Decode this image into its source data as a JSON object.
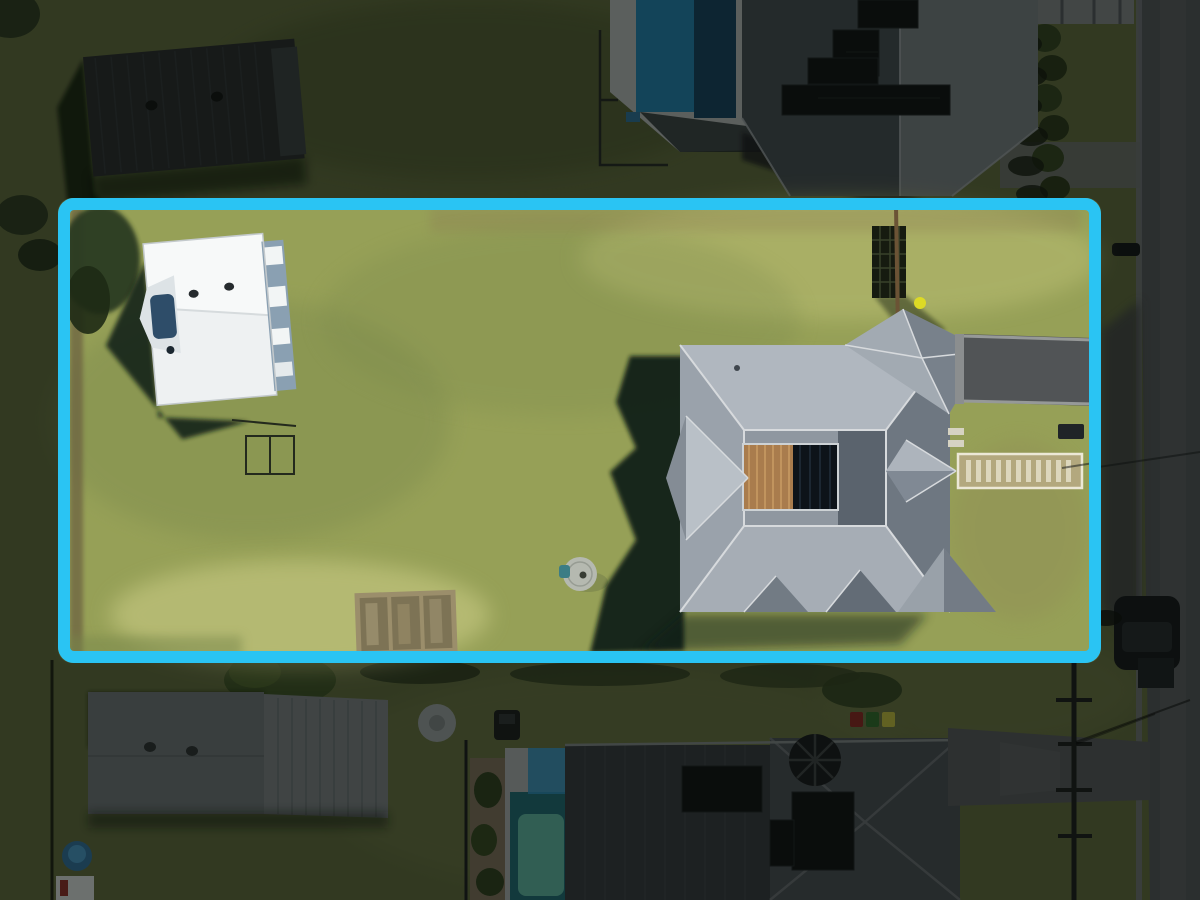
{
  "scene": {
    "type": "aerial-drone-photo",
    "description": "Top-down aerial photograph of a residential allotment outlined with a thick cyan boundary; large lawn with white shed on the left, grey hip-roof house with central courtyard deck on the right, driveway and paver path to the street; neighbouring houses, pools and road are dimmed outside the boundary",
    "highlight": {
      "shape": "rounded-rectangle",
      "border_color": "#2ac4f3"
    },
    "objects": [
      "boundary-highlight",
      "lot-lawn",
      "white-shed",
      "boat",
      "clothesline",
      "garden-beds",
      "concrete-pad",
      "trellis-gate",
      "yellow-ball",
      "main-house",
      "courtyard-deck",
      "driveway",
      "paver-path",
      "letterbox",
      "house-shadow",
      "shed-shadow",
      "neighbor-shed-top-left",
      "neighbor-house-top",
      "neighbor-pool-top",
      "hedge-row",
      "neighbor-shed-bottom-left",
      "kiddie-pool",
      "trailer",
      "round-pad",
      "mower",
      "neighbor-pool-bottom",
      "neighbor-house-bottom",
      "solar-panels",
      "wheelie-bins",
      "trampoline",
      "street-road",
      "power-pole",
      "parked-car"
    ]
  },
  "colors": {
    "cyan": "#2ac4f3",
    "dim": "rgba(9,13,10,0.52)",
    "grass_out": "#5f6a3c",
    "grass_out_light": "#6f7a46",
    "grass_out_dark": "#46512c",
    "grass_in": "#96a057",
    "grass_in_light": "#b9bd72",
    "grass_in_bright": "#c9cb84",
    "grass_in_dark": "#78874b",
    "dirt": "#8d7c52",
    "shadow": "#0d1a12",
    "tree_dark": "#2c3a20",
    "hedge": "#31411f",
    "road": "#515458",
    "road_light": "#5f6266",
    "road_dark": "#3f4245",
    "kerb": "#70737a",
    "wall_light": "#7f8486",
    "shed_dark": "#26292b",
    "shed_dark_end": "#383d3f",
    "shed_white": "#eef1f2",
    "shed_white_lit": "#f7f9f9",
    "shed_wall": "#8aa0b2",
    "boat_cover": "#2e4d69",
    "roof_n": "#767d83",
    "roof_n_shade": "#424a50",
    "solar": "#0b0e10",
    "pool_deck": "#b4b8b9",
    "pool_water": "#1f7fb0",
    "pool_water_dark": "#123f5e",
    "deck2": "#a9adaf",
    "pool2": "#1d6a74",
    "pool2_light": "#5cb7a4",
    "garden_rock": "#7d6f5b",
    "roof_b1": "#33383d",
    "roof_b2": "#454b52",
    "roof_b_ridge": "#6a7076",
    "drive2": "#54575a",
    "bin_red": "#8a2420",
    "bin_green": "#2f6b2a",
    "bin_yellow": "#c0bd3e",
    "tramp": "#141619",
    "pole": "#17191a",
    "car_body": "#111417",
    "car_top": "#23272b",
    "roof_lit": "#b0b7bf",
    "roof_mid": "#9aa2ab",
    "roof_low": "#a6adb5",
    "roof_dark": "#6e7781",
    "roof_inner": "#8f97a0",
    "roof_inner_dark": "#5a636d",
    "ridge": "#d7dadd",
    "courtyard_dark": "#0d1319",
    "deck_wood": "#a97c4d",
    "deck_wood_light": "#c79a63",
    "bay": "#adb4bc",
    "steps": "#d6d3c2",
    "drive": "#515456",
    "drive_edge": "#969998",
    "path_base": "#b3a87e",
    "path_border": "#ece8d6",
    "paver": "#ddd7bd",
    "letterbox": "#202427",
    "bed_wood": "#9b8e6b",
    "bed_soil": "#7d7355",
    "pad": "#b5b9b0",
    "pad_dot": "#383d34",
    "teal_item": "#3c7d85",
    "ball": "#ddda25",
    "trailer": "#d8dbdc"
  }
}
